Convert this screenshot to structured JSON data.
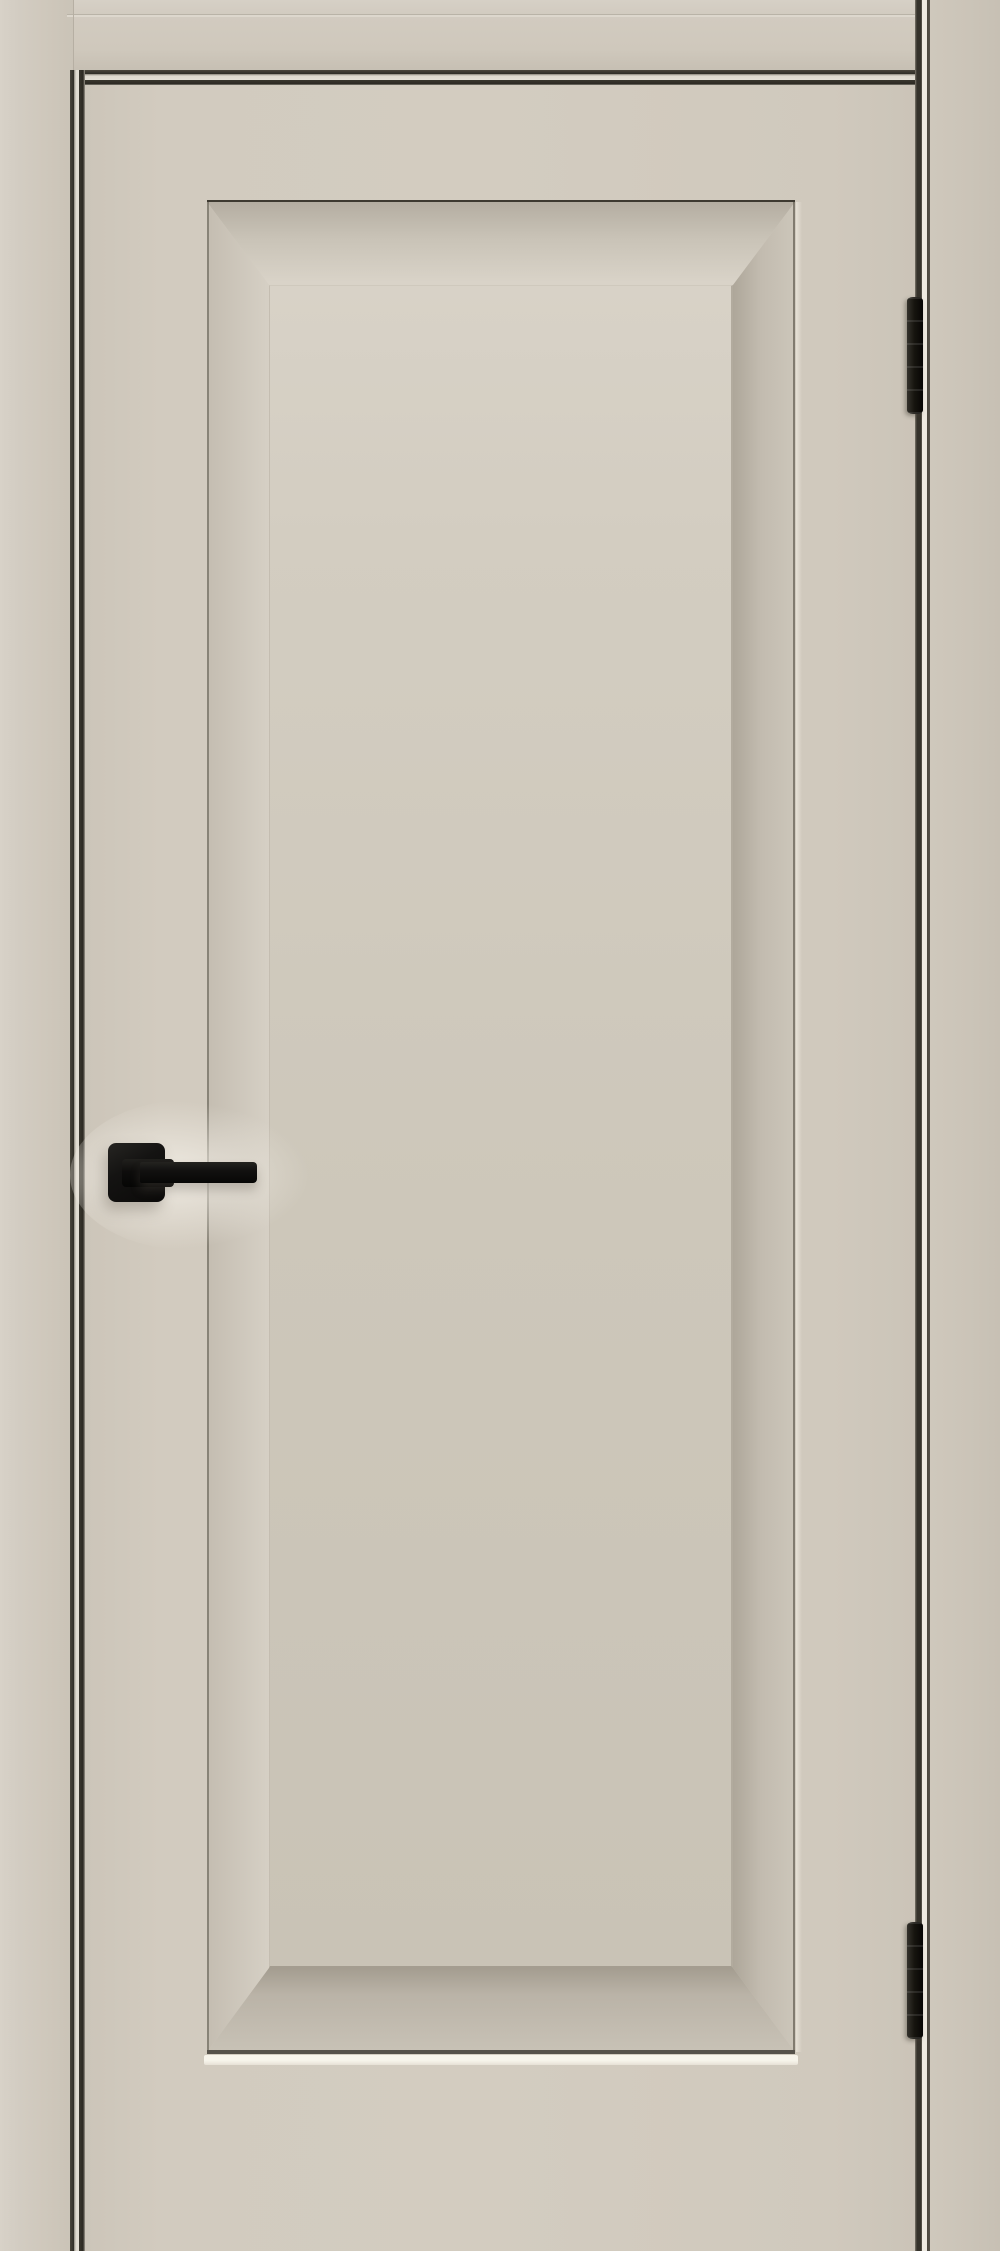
{
  "scene": {
    "type": "product-photo",
    "alt": "Closed beige matte interior door with a single large recessed bevel-edge panel, mounted in a matching beige frame. Black square-rosette lever handle on the left stile, two black hinges on the right edge. No text visible.",
    "door_state": "closed",
    "hinge_side": "right",
    "handle_side": "left"
  },
  "parts": {
    "wall": {
      "label": "wall backdrop",
      "color": "#d8d2c8"
    },
    "frame_left": {
      "label": "door frame casing, left jamb",
      "color": "#cfc8bc"
    },
    "frame_head": {
      "label": "door frame casing, head",
      "color": "#cfc8bc"
    },
    "frame_right": {
      "label": "door frame casing, right jamb",
      "color": "#c7c0b4"
    },
    "gap_top": {
      "label": "gap shadow between door and frame head",
      "color": "#34312a"
    },
    "gap_left": {
      "label": "gap shadow between door and left jamb",
      "color": "#34312a"
    },
    "gap_right": {
      "label": "gap and bright frame edge on hinge side",
      "color": "#efebe2"
    },
    "door_leaf": {
      "label": "door leaf, matte greige finish",
      "color": "#d1cabe"
    },
    "panel": {
      "label": "recessed door panel with wide bevel border",
      "color": "#ccc6b9"
    },
    "panel_bevels": {
      "label": "bevel slopes around recessed panel",
      "shadow_color": "#aea79b",
      "light_color": "#dcd6cb"
    },
    "panel_under_highlight": {
      "label": "bright highlight line under panel",
      "color": "#f6f3ea"
    },
    "handle": {
      "label": "black square-rosette lever handle pointing right",
      "color": "#121110"
    },
    "rosette": {
      "label": "square handle rosette",
      "color": "#141312"
    },
    "lever": {
      "label": "straight lever grip",
      "color": "#121110"
    },
    "hinge_top": {
      "label": "upper black hinge",
      "color": "#1a1816"
    },
    "hinge_bottom": {
      "label": "lower black hinge",
      "color": "#1a1816"
    }
  },
  "counts": {
    "hinges": 2,
    "panels": 1,
    "handles": 1
  },
  "palette": {
    "wall": "#d8d2c8",
    "frame_face": "#cfc8bc",
    "frame_face_dark": "#c7c0b4",
    "frame_edge_bright": "#efebe2",
    "door_face": "#d3ccc0",
    "panel_light": "#d8d2c7",
    "panel_mid": "#c9c3b6",
    "bevel_shadow": "#b4ada1",
    "bevel_light": "#d9d3c8",
    "gap_dark": "#34312a",
    "hardware_black": "#0b0a09",
    "hinge_black": "#17150f"
  }
}
